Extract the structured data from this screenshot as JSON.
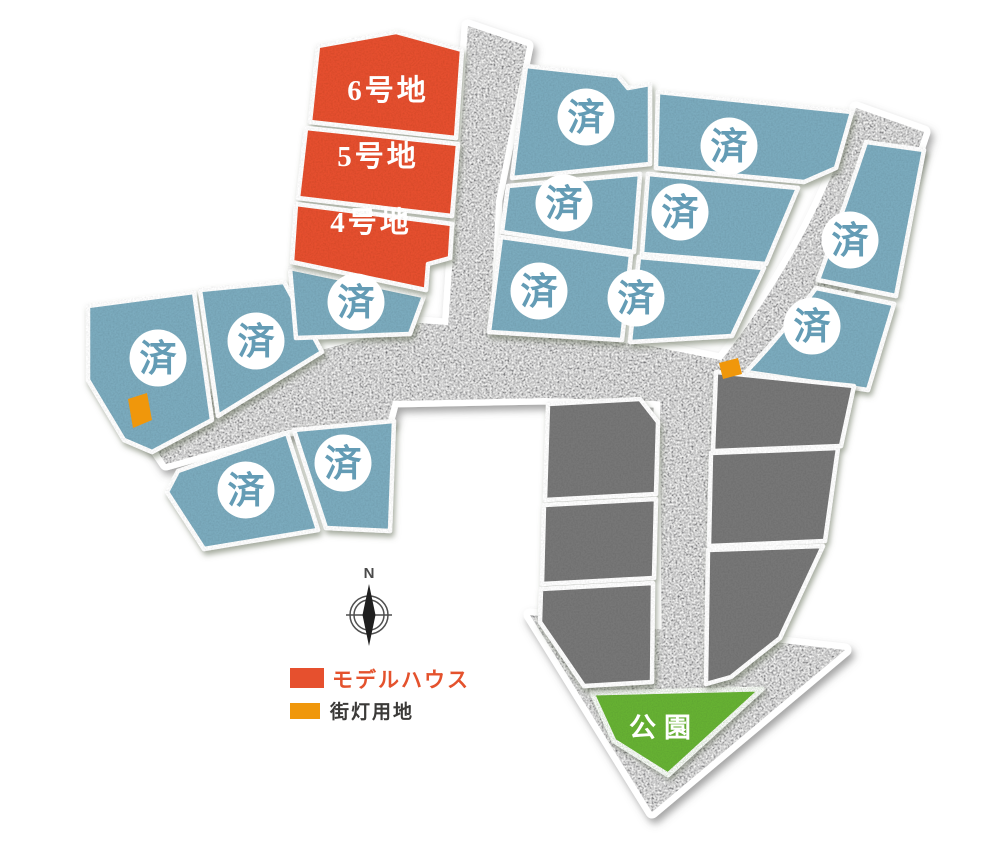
{
  "lots": {
    "available": [
      {
        "id": "6",
        "label": "6号地"
      },
      {
        "id": "5",
        "label": "5号地"
      },
      {
        "id": "4",
        "label": "4号地"
      }
    ],
    "sold_label": "済",
    "sold_count": 13
  },
  "park": {
    "label": "公園"
  },
  "compass": {
    "north_label": "N"
  },
  "legend": {
    "items": [
      {
        "key": "model_house",
        "label": "モデルハウス"
      },
      {
        "key": "street_light",
        "label": "街灯用地"
      }
    ]
  },
  "colors": {
    "model_house": "#e6502e",
    "sold_lot": "#7cabbe",
    "sold_text": "#649cb5",
    "reserved_lot": "#777777",
    "road": "#cecece",
    "park": "#66b232",
    "street_light": "#f0970b",
    "legend_model_house_text": "#e4522d",
    "legend_street_light_text": "#3b3a38"
  }
}
